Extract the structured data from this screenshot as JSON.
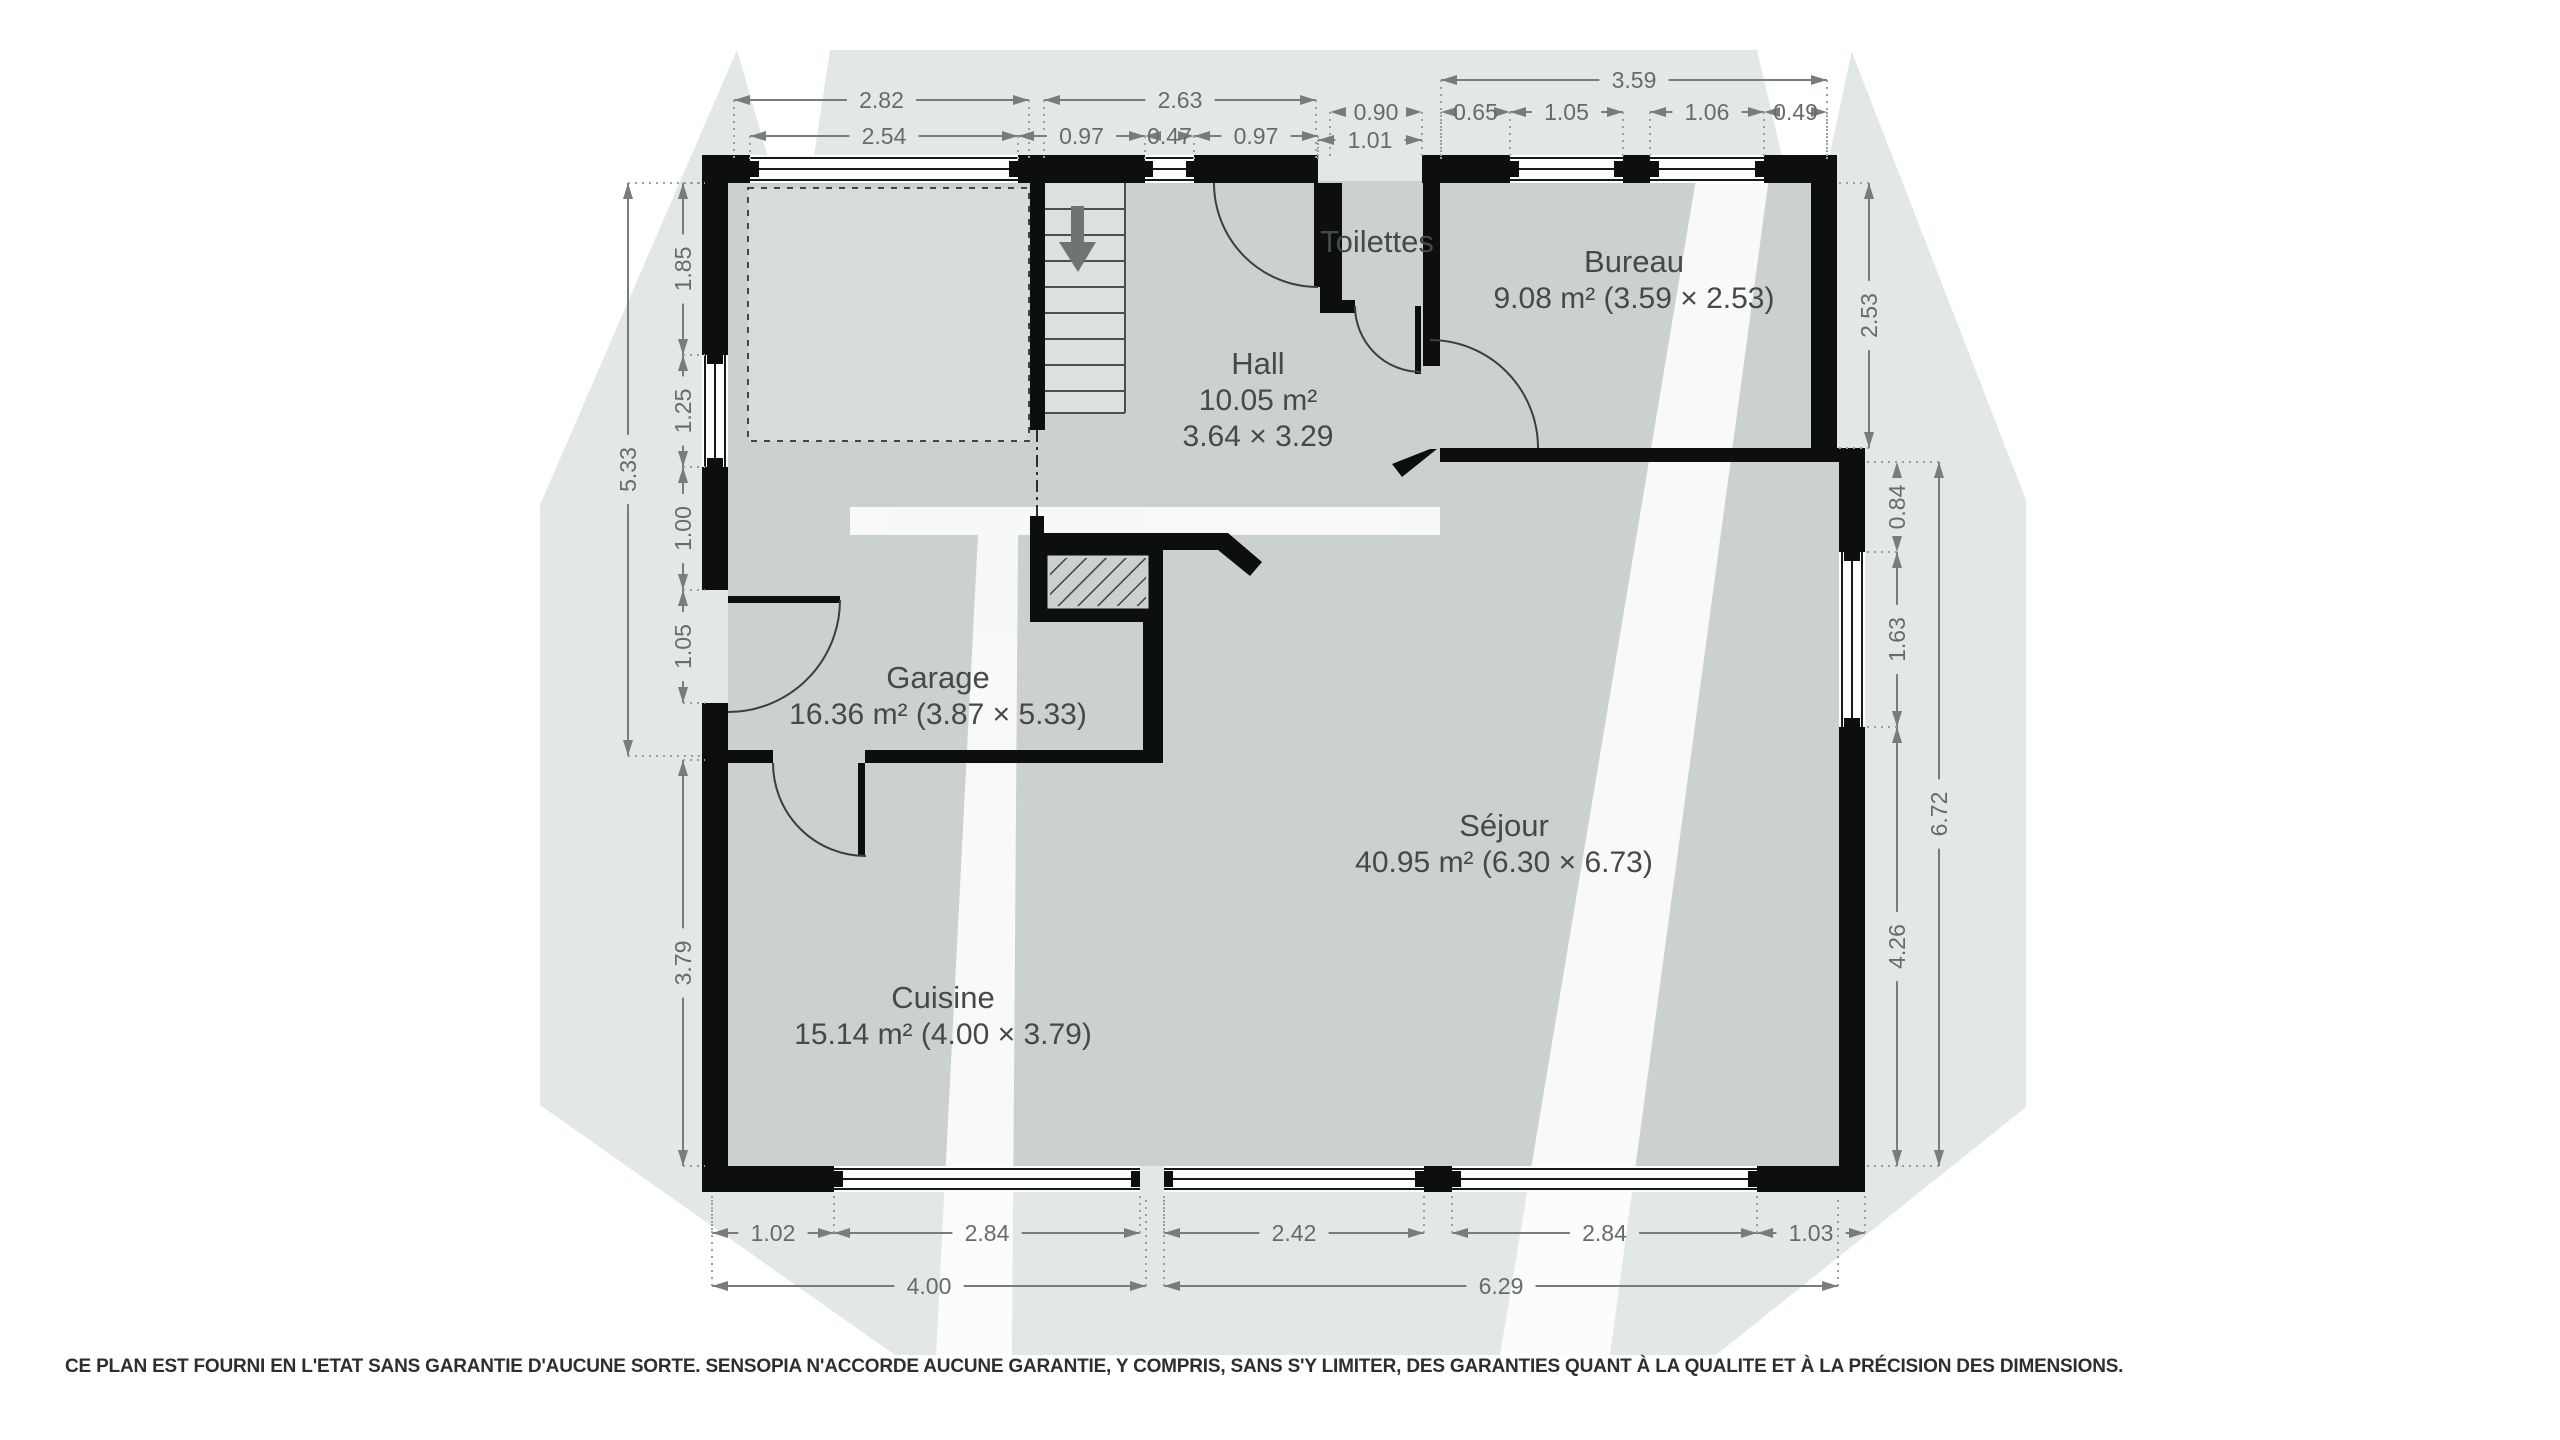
{
  "rooms": {
    "toilettes": {
      "name": "Toilettes"
    },
    "bureau": {
      "name": "Bureau",
      "details": "9.08 m² (3.59 × 2.53)"
    },
    "hall": {
      "name": "Hall",
      "area": "10.05 m²",
      "size": "3.64 × 3.29"
    },
    "garage": {
      "name": "Garage",
      "details": "16.36 m² (3.87 × 5.33)"
    },
    "sejour": {
      "name": "Séjour",
      "details": "40.95 m² (6.30 × 6.73)"
    },
    "cuisine": {
      "name": "Cuisine",
      "details": "15.14 m² (4.00 × 3.79)"
    }
  },
  "dimensions": {
    "top_outer": [
      "2.82",
      "2.63",
      "3.59"
    ],
    "top_inner": [
      "2.54",
      "0.97",
      "0.47",
      "0.97",
      "0.90",
      "1.01",
      "0.65",
      "1.05",
      "1.06",
      "0.49"
    ],
    "left_outer": [
      "5.33"
    ],
    "left_inner": [
      "1.85",
      "1.25",
      "1.00",
      "1.05",
      "3.79"
    ],
    "right_inner": [
      "2.53",
      "0.84",
      "1.63",
      "4.26"
    ],
    "right_outer": [
      "6.72"
    ],
    "bottom_inner": [
      "1.02",
      "2.84",
      "2.42",
      "2.84",
      "1.03"
    ],
    "bottom_outer": [
      "4.00",
      "6.29"
    ]
  },
  "colors": {
    "wall": "#0d0f0e",
    "floor": "#cbd2ce",
    "floor_light": "#dbe1de",
    "backdrop": "#e2e8e4",
    "dim_line": "#787d7a",
    "arrow": "#6f7471"
  },
  "disclaimer": "CE PLAN EST FOURNI EN L'ETAT SANS GARANTIE D'AUCUNE SORTE. SENSOPIA N'ACCORDE AUCUNE GARANTIE, Y COMPRIS, SANS S'Y LIMITER, DES GARANTIES QUANT À LA QUALITE ET À LA PRÉCISION DES DIMENSIONS."
}
